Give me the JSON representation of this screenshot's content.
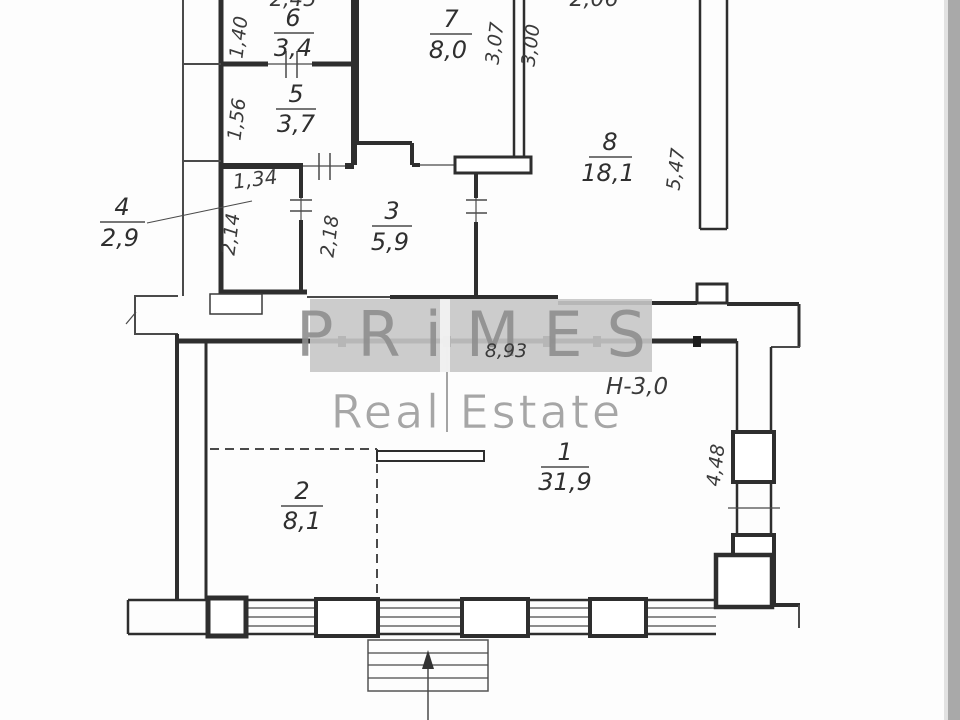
{
  "plan_title": "apartment-floor-plan",
  "watermark": {
    "line1": "PRiMES",
    "line2": "Real Estate"
  },
  "rooms": [
    {
      "number": "1",
      "area": "31,9"
    },
    {
      "number": "2",
      "area": "8,1"
    },
    {
      "number": "3",
      "area": "5,9"
    },
    {
      "number": "4",
      "area": "2,9"
    },
    {
      "number": "5",
      "area": "3,7"
    },
    {
      "number": "6",
      "area": "3,4"
    },
    {
      "number": "7",
      "area": "8,0"
    },
    {
      "number": "8",
      "area": "18,1"
    }
  ],
  "dimensions": {
    "d_1_40": "1,40",
    "d_1_56": "1,56",
    "d_1_34": "1,34",
    "d_2_14": "2,14",
    "d_2_18": "2,18",
    "d_3_07": "3,07",
    "d_3_00": "3,00",
    "d_5_47": "5,47",
    "d_8_93": "8,93",
    "d_4_48": "4,48",
    "height_note": "Н-3,0",
    "top_cut_left": "2,45",
    "top_cut_right": "2,06"
  },
  "colors": {
    "wall": "#2e2e2e",
    "dimension_text": "#3a3a3a",
    "watermark_band": "#c7c7c7",
    "watermark_text": "#8f8f8f",
    "edge_stripe": "#a9a9a9"
  }
}
